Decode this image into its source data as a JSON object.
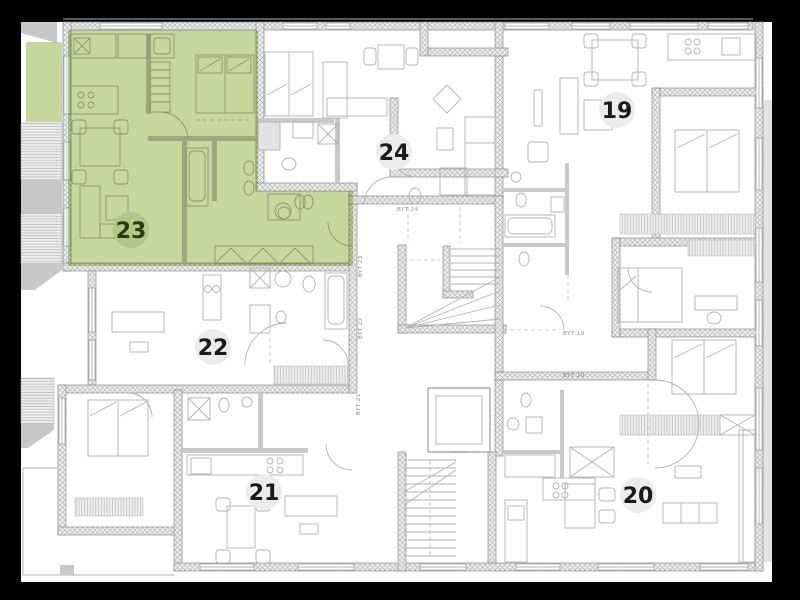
{
  "plan": {
    "apartments": [
      {
        "number": "19",
        "badge": {
          "x": 617,
          "y": 110
        },
        "highlighted": false
      },
      {
        "number": "20",
        "badge": {
          "x": 638,
          "y": 495
        },
        "highlighted": false
      },
      {
        "number": "21",
        "badge": {
          "x": 264,
          "y": 492
        },
        "highlighted": false
      },
      {
        "number": "22",
        "badge": {
          "x": 213,
          "y": 347
        },
        "highlighted": false
      },
      {
        "number": "23",
        "badge": {
          "x": 131,
          "y": 230
        },
        "highlighted": true
      },
      {
        "number": "24",
        "badge": {
          "x": 394,
          "y": 152
        },
        "highlighted": false
      }
    ],
    "unit_labels": [
      {
        "text": "BYT 24",
        "x": 397,
        "y": 211,
        "rotate": 0
      },
      {
        "text": "BYT 23",
        "x": 362,
        "y": 277,
        "rotate": -90
      },
      {
        "text": "BYT 22",
        "x": 362,
        "y": 339,
        "rotate": -90
      },
      {
        "text": "BYT 21",
        "x": 360,
        "y": 415,
        "rotate": -90
      },
      {
        "text": "BYT 19",
        "x": 563,
        "y": 335,
        "rotate": 0
      },
      {
        "text": "BYT 20",
        "x": 563,
        "y": 377,
        "rotate": 0
      }
    ],
    "colors": {
      "frame": "#000000",
      "paper": "#ffffff",
      "wall_fill": "#ededed",
      "wall_stroke": "#8d8d8d",
      "hatch_line": "#b0b0b0",
      "thin_line": "#b2b2b2",
      "dark_line": "#9a9a9a",
      "partition": "#c9c9c9",
      "outside_gray": "#c8c8c8",
      "window_line": "#9a9a9a",
      "dash_line": "#bdbdbd",
      "highlight": "#c6d79d",
      "badge_bg": "#ececec",
      "badge_text": "#1a1a1a",
      "highlight_badge_bg": "#b3c686",
      "highlight_badge_text": "#2c3a10",
      "label_text": "#8f8f8f"
    }
  }
}
